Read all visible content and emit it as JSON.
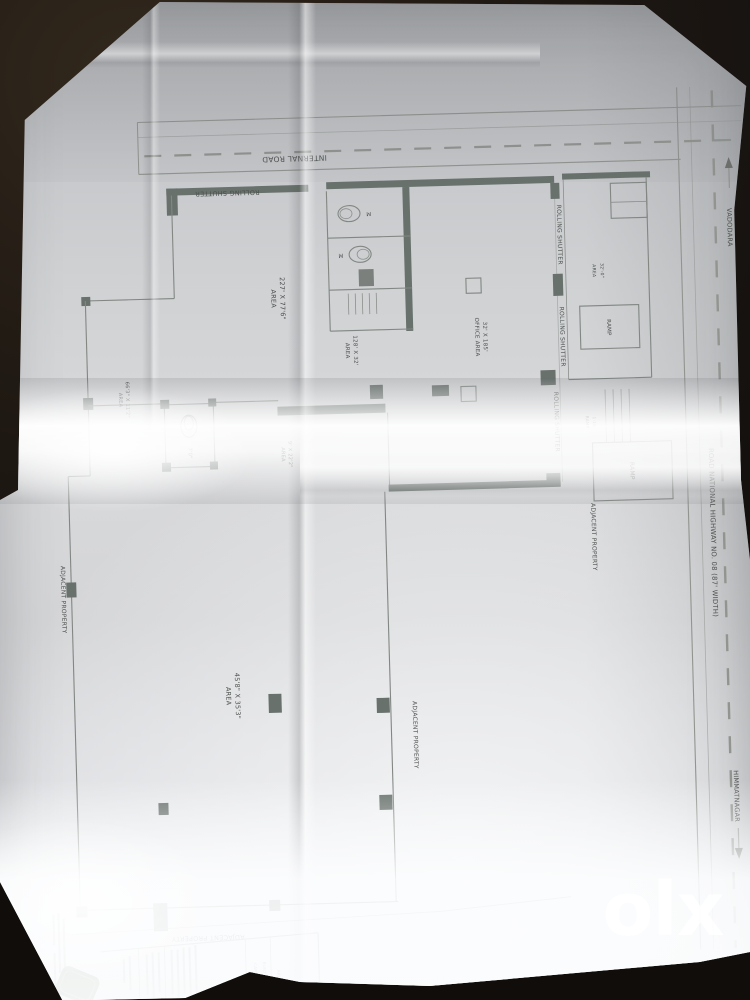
{
  "colors": {
    "background": "#1a1512",
    "paper": "#d7d8da",
    "ink": "#4c504d",
    "wall": "#68716c",
    "stamp_green": "#394d22",
    "watermark_white": "#ffffff"
  },
  "roads": {
    "internal": {
      "label": "INTERNAL ROAD"
    },
    "highway": {
      "label": "ROAD NATIONAL HIGHWAY NO. 08 (87' WIDTH)",
      "north": "VADODARA",
      "south": "HIMMATNAGAR"
    }
  },
  "labels": {
    "rolling_shutter": "ROLLING SHUTTER",
    "adjacent_property": "ADJACENT PROPERTY",
    "ramp": "RAMP",
    "ramp_ratio": "1:15",
    "toilet_dim": "7'0\"",
    "wc": "M"
  },
  "areas": {
    "main_hall": {
      "line1": "AREA",
      "line2": "227' X 77'6\""
    },
    "strip": {
      "line1": "AREA",
      "line2": "128' X 32'"
    },
    "office": {
      "line1": "OFFICE AREA",
      "line2": "32' X 185'"
    },
    "left_strip": {
      "line1": "AREA",
      "line2": "66'3\" X 11'2\""
    },
    "mid_strip": {
      "line1": "AREA",
      "line2": "9' X 22'2\""
    },
    "bottom_hall": {
      "line1": "AREA",
      "line2": "45'8\" X 35'3\""
    },
    "store": {
      "line1": "AREA",
      "line2": "32'-0\""
    }
  },
  "titleblock": {
    "compass": "N",
    "carpet": "CARPET AREA",
    "builtup": "BUILT UP AREA",
    "area": "AREA"
  },
  "watermark": {
    "text": "olx"
  }
}
